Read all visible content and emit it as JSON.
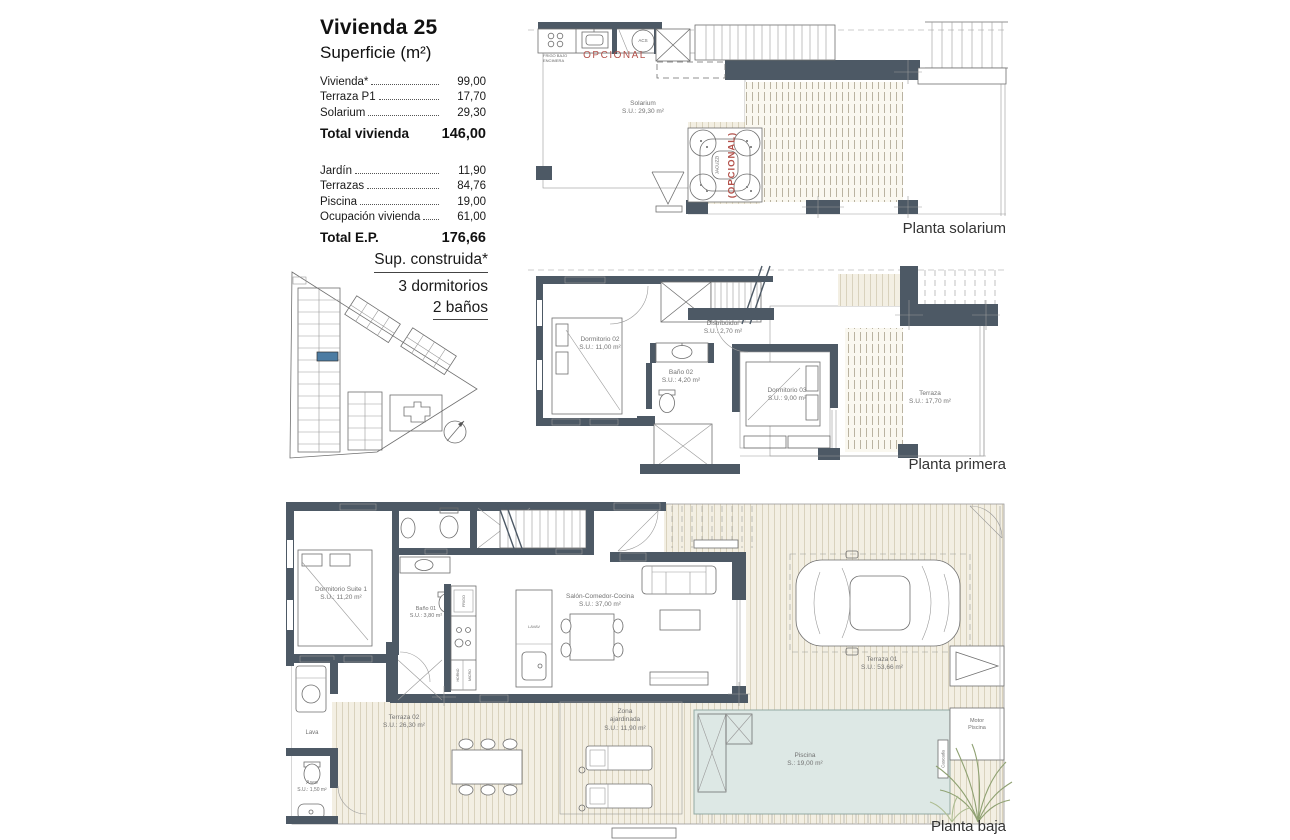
{
  "header": {
    "title": "Vivienda 25",
    "subtitle": "Superficie (m²)"
  },
  "surface": {
    "rows": [
      {
        "label": "Vivienda*",
        "value": "99,00"
      },
      {
        "label": "Terraza P1",
        "value": "17,70"
      },
      {
        "label": "Solarium",
        "value": "29,30"
      }
    ],
    "total_vivienda": {
      "label": "Total vivienda",
      "value": "146,00"
    },
    "rows2": [
      {
        "label": "Jardín",
        "value": "11,90"
      },
      {
        "label": "Terrazas",
        "value": "84,76"
      },
      {
        "label": "Piscina",
        "value": "19,00"
      },
      {
        "label": "Ocupación vivienda",
        "value": "61,00"
      }
    ],
    "total_ep": {
      "label": "Total E.P.",
      "value": "176,66"
    }
  },
  "built": {
    "line1": "Sup. construida*",
    "line2": "3 dormitorios",
    "line3": "2 baños"
  },
  "floors": {
    "solarium": {
      "label": "Planta solarium",
      "solarium_name": "Solarium",
      "solarium_area": "S.U.: 29,30 m²",
      "opcional": "OPCIONAL",
      "frigo": "FRIGO BAJO ENCIMERA",
      "acs": "ACS",
      "jacuzzi": "JACUZZI",
      "jacuzzi_opcional": "(OPCIONAL)"
    },
    "primera": {
      "label": "Planta primera",
      "dorm02_name": "Dormitorio 02",
      "dorm02_area": "S.U.: 11,00 m²",
      "distribuidor_name": "Distribuidor",
      "distribuidor_area": "S.U.: 2,70 m²",
      "bano02_name": "Baño 02",
      "bano02_area": "S.U.: 4,20 m²",
      "dorm03_name": "Dormitorio 03",
      "dorm03_area": "S.U.: 9,00 m²",
      "terraza_name": "Terraza",
      "terraza_area": "S.U.: 17,70 m²"
    },
    "baja": {
      "label": "Planta baja",
      "suite_name": "Dormitorio Suite 1",
      "suite_area": "S.U.: 11,20 m²",
      "bano01_name": "Baño 01",
      "bano01_area": "S.U.: 3,80 m²",
      "salon_name": "Salón-Comedor-Cocina",
      "salon_area": "S.U.: 37,00 m²",
      "terraza01_name": "Terraza 01",
      "terraza01_area": "S.U.: 53,66 m²",
      "terraza02_name": "Terraza 02",
      "terraza02_area": "S.U.: 26,30 m²",
      "zona_line1": "Zona",
      "zona_line2": "ajardinada",
      "zona_area": "S.U.: 11,90 m²",
      "piscina_name": "Piscina",
      "piscina_area": "S.: 19,00 m²",
      "motor_line1": "Motor",
      "motor_line2": "Piscina",
      "cascada": "Cascada",
      "aseo_name": "Aseo",
      "aseo_area": "S.U.: 1,50 m²",
      "lava": "Lava",
      "lavav": "LAVAV",
      "frigo": "FRIGO",
      "horno": "HORNO",
      "micro": "MICRO"
    }
  },
  "colors": {
    "wall": "#4d5965",
    "deck_bg": "#f3efe3",
    "deck_line": "#d9d2bd",
    "pool": "#dde8e5",
    "highlight": "#4c7ca3",
    "accent_red": "#b3524b",
    "label_gray": "#737373",
    "plant_green": "#8fa172"
  }
}
